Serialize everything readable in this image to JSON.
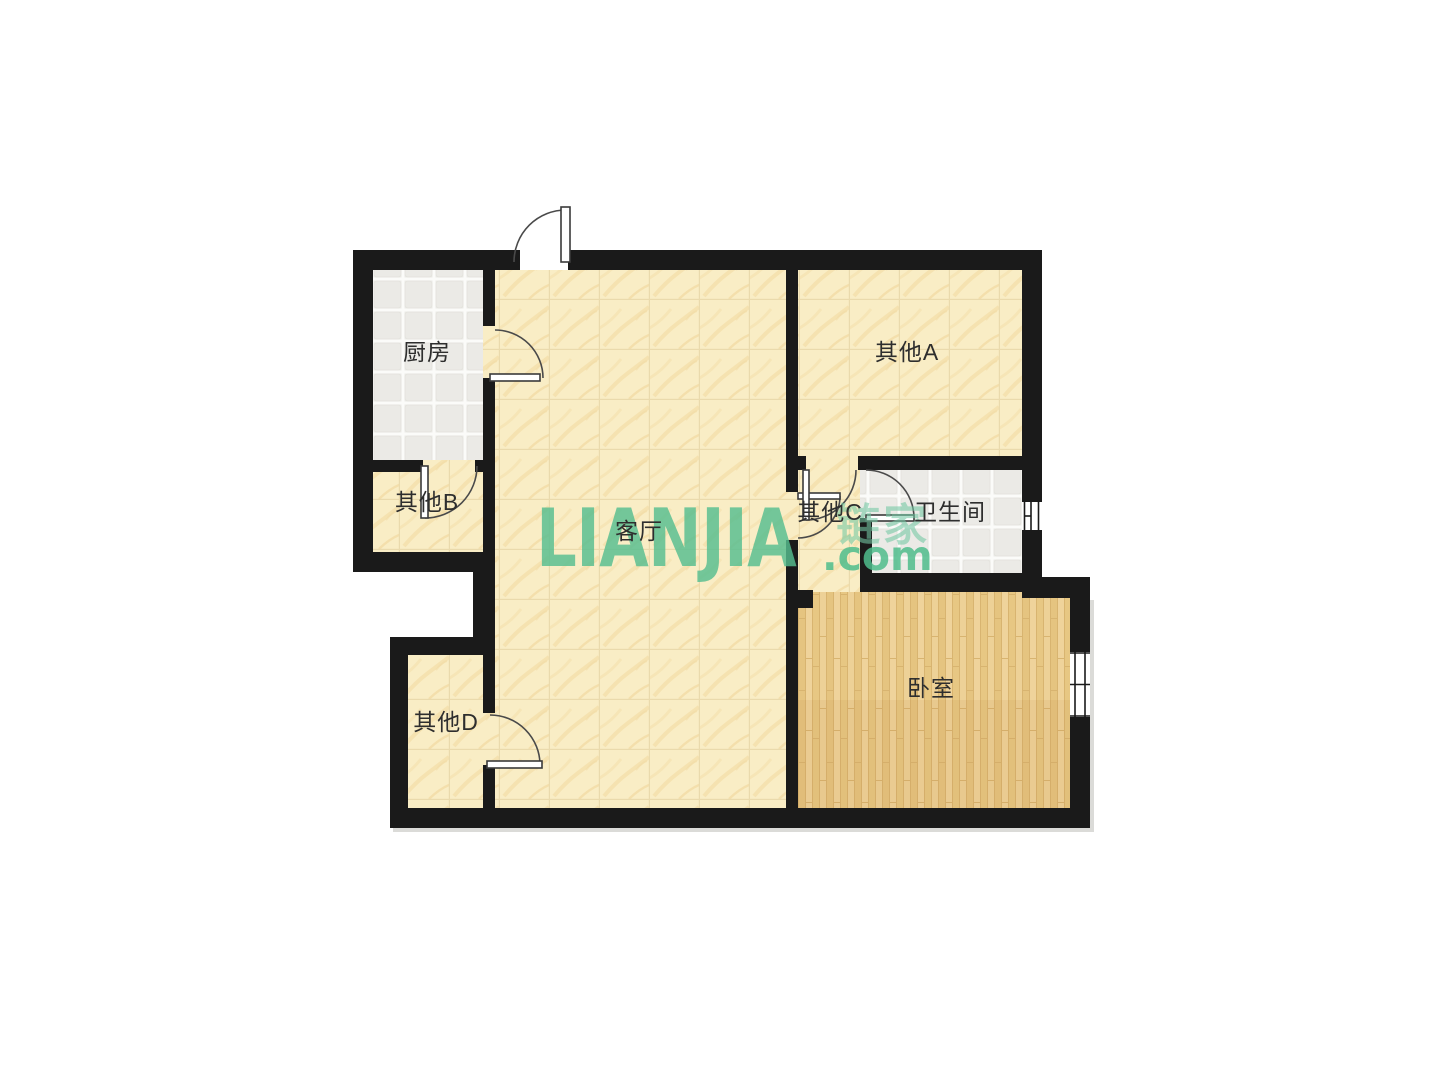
{
  "plan": {
    "type": "residential-floor-plan",
    "rooms": [
      {
        "id": "kitchen",
        "label": "厨房",
        "floor": "gray-tile"
      },
      {
        "id": "other-a",
        "label": "其他A",
        "floor": "yellow-tile"
      },
      {
        "id": "other-b",
        "label": "其他B",
        "floor": "yellow-tile"
      },
      {
        "id": "living",
        "label": "客厅",
        "floor": "yellow-tile"
      },
      {
        "id": "other-c",
        "label": "其他C",
        "floor": "yellow-tile"
      },
      {
        "id": "bathroom",
        "label": "卫生间",
        "floor": "gray-tile"
      },
      {
        "id": "other-d",
        "label": "其他D",
        "floor": "yellow-tile"
      },
      {
        "id": "bedroom",
        "label": "卧室",
        "floor": "wood"
      }
    ],
    "features": {
      "doors": [
        "entry-door",
        "kitchen-door",
        "other-b-door",
        "other-d-door",
        "living-other-c-door",
        "other-a-other-c-door",
        "bathroom-door"
      ],
      "windows": [
        "bathroom-window",
        "bedroom-window"
      ]
    }
  },
  "watermark": {
    "main": "LIANJIA",
    "cn": "链家",
    "suffix": ".com"
  },
  "colors": {
    "wall": "#1A1A1A",
    "floor_tile_yellow": "#F9EDC5",
    "floor_tile_gray": "#EBEAE6",
    "floor_wood": "#EACC8F",
    "watermark_green": "#56BE90",
    "label_text": "#2E2E2E",
    "background": "#FFFFFF"
  }
}
